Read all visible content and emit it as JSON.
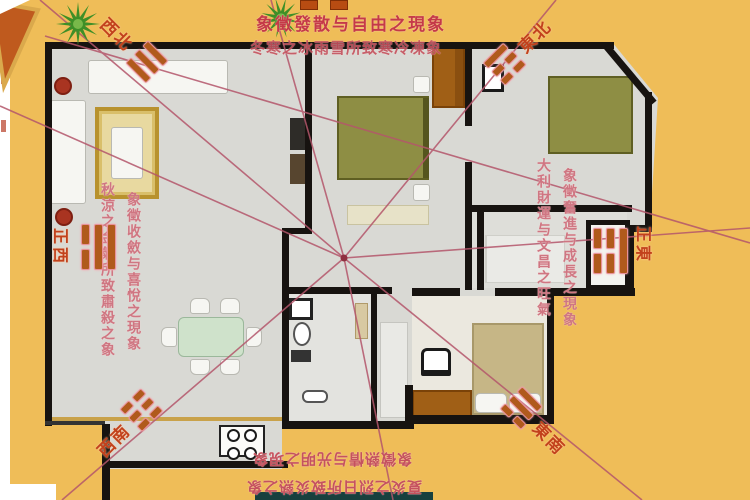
{
  "colors": {
    "background": "#efbd58",
    "floor": "#d9d9d4",
    "wall": "#171310",
    "radial_line": "#b4566b",
    "annotation_red": "#c53a47",
    "marker_red": "#c2411c",
    "bed_olive": "#8e8e44",
    "bed_khaki": "#c6b686",
    "wood_brown": "#a05f16",
    "rug_gold": "#c8a237",
    "plant_green": "#3e8f27"
  },
  "annotations": {
    "top_line1": "象徵發散与自由之現象",
    "top_line2": "冬寒之冰雨雪所致寒冷凍象",
    "left_col1": "秋涼之金氣所致肅殺之象",
    "left_col2": "象徵收斂与喜悅之現象",
    "right_col1": "大利財運与文昌之旺氣",
    "right_col2": "象徵奮進与成長之現象",
    "bottom_line1": "象徵熱情与光明之現象",
    "bottom_line2": "夏炎之烈日所致炎熱之象"
  },
  "directions": {
    "nw": {
      "label": "西北"
    },
    "ne": {
      "label": "東北"
    },
    "w": {
      "label": "正西"
    },
    "e": {
      "label": "正東"
    },
    "sw": {
      "label": "西南"
    },
    "se": {
      "label": "東南"
    }
  }
}
